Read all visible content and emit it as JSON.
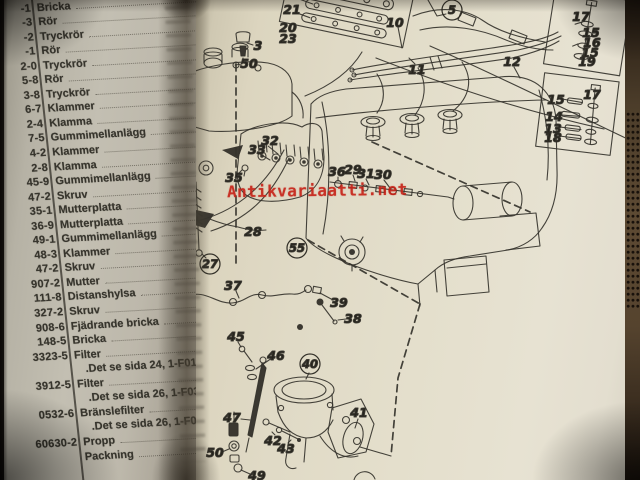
{
  "watermark": {
    "text": "Antikvariaatti.net",
    "color": "#c52116"
  },
  "photo": {
    "paper_color": "#e4dfcc",
    "left_page_color": "#bdb8ab",
    "background_color": "#191512",
    "ink_color": "#35332c"
  },
  "parts_list": {
    "rows": [
      {
        "num": "-1",
        "name": "Bricka"
      },
      {
        "num": "-3",
        "name": "Rör"
      },
      {
        "num": "-2",
        "name": "Tryckrör"
      },
      {
        "num": "-1",
        "name": "Rör"
      },
      {
        "num": "2-0",
        "name": "Tryckrör"
      },
      {
        "num": "5-8",
        "name": "Rör"
      },
      {
        "num": "3-8",
        "name": "Tryckrör"
      },
      {
        "num": "6-7",
        "name": "Klammer"
      },
      {
        "num": "2-4",
        "name": "Klamma"
      },
      {
        "num": "7-5",
        "name": "Gummimellanlägg"
      },
      {
        "num": "4-2",
        "name": "Klammer"
      },
      {
        "num": "2-8",
        "name": "Klamma"
      },
      {
        "num": "45-9",
        "name": "Gummimellanlägg"
      },
      {
        "num": "47-2",
        "name": "Skruv"
      },
      {
        "num": "35-1",
        "name": "Mutterplatta"
      },
      {
        "num": "36-9",
        "name": "Mutterplatta"
      },
      {
        "num": "49-1",
        "name": "Gummimellanlägg"
      },
      {
        "num": "48-3",
        "name": "Klammer"
      },
      {
        "num": "47-2",
        "name": "Skruv"
      },
      {
        "num": "907-2",
        "name": "Mutter"
      },
      {
        "num": "111-8",
        "name": "Distanshylsa"
      },
      {
        "num": "327-2",
        "name": "Skruv"
      },
      {
        "num": "908-6",
        "name": "Fjädrande bricka"
      },
      {
        "num": "148-5",
        "name": "Bricka"
      },
      {
        "num": "3323-5",
        "name": "Filter"
      },
      {
        "num": "",
        "name": ".Det se sida 24, 1-F01",
        "indent": true
      },
      {
        "num": "3912-5",
        "name": "Filter"
      },
      {
        "num": "",
        "name": ".Det se sida 26, 1-F03",
        "indent": true
      },
      {
        "num": "0532-6",
        "name": "Bränslefilter"
      },
      {
        "num": "",
        "name": ".Det se sida 26, 1-F03",
        "indent": true
      },
      {
        "num": "60630-2",
        "name": "Propp"
      },
      {
        "num": "",
        "name": "Packning"
      }
    ]
  },
  "diagram": {
    "callouts": [
      {
        "label": "21",
        "x": 292,
        "y": 10
      },
      {
        "label": "20",
        "x": 288,
        "y": 28
      },
      {
        "label": "23",
        "x": 288,
        "y": 39
      },
      {
        "label": "3",
        "x": 258,
        "y": 46
      },
      {
        "label": "50",
        "x": 249,
        "y": 64
      },
      {
        "label": "5",
        "x": 452,
        "y": 10,
        "circled": true
      },
      {
        "label": "10",
        "x": 395,
        "y": 23
      },
      {
        "label": "11",
        "x": 417,
        "y": 70
      },
      {
        "label": "12",
        "x": 512,
        "y": 62
      },
      {
        "label": "17",
        "x": 581,
        "y": 17
      },
      {
        "label": "15",
        "x": 591,
        "y": 33
      },
      {
        "label": "16",
        "x": 592,
        "y": 43
      },
      {
        "label": "15",
        "x": 590,
        "y": 53
      },
      {
        "label": "19",
        "x": 587,
        "y": 62
      },
      {
        "label": "17",
        "x": 592,
        "y": 95
      },
      {
        "label": "15",
        "x": 556,
        "y": 100
      },
      {
        "label": "14",
        "x": 554,
        "y": 117
      },
      {
        "label": "13",
        "x": 553,
        "y": 129
      },
      {
        "label": "18",
        "x": 553,
        "y": 138
      },
      {
        "label": "32",
        "x": 270,
        "y": 141
      },
      {
        "label": "33",
        "x": 257,
        "y": 150
      },
      {
        "label": "35",
        "x": 234,
        "y": 178
      },
      {
        "label": "36",
        "x": 337,
        "y": 172
      },
      {
        "label": "29",
        "x": 353,
        "y": 170
      },
      {
        "label": "31",
        "x": 366,
        "y": 174
      },
      {
        "label": "30",
        "x": 383,
        "y": 175
      },
      {
        "label": "28",
        "x": 253,
        "y": 232
      },
      {
        "label": "27",
        "x": 210,
        "y": 264,
        "circled": true
      },
      {
        "label": "55",
        "x": 297,
        "y": 248,
        "circled": true
      },
      {
        "label": "37",
        "x": 233,
        "y": 286
      },
      {
        "label": "39",
        "x": 339,
        "y": 303
      },
      {
        "label": "38",
        "x": 353,
        "y": 319
      },
      {
        "label": "45",
        "x": 236,
        "y": 337
      },
      {
        "label": "46",
        "x": 276,
        "y": 356
      },
      {
        "label": "40",
        "x": 310,
        "y": 364,
        "circled": true
      },
      {
        "label": "47",
        "x": 232,
        "y": 418
      },
      {
        "label": "41",
        "x": 359,
        "y": 413
      },
      {
        "label": "42",
        "x": 273,
        "y": 441
      },
      {
        "label": "43",
        "x": 286,
        "y": 449
      },
      {
        "label": "50",
        "x": 215,
        "y": 453
      },
      {
        "label": "49",
        "x": 257,
        "y": 476
      }
    ]
  }
}
